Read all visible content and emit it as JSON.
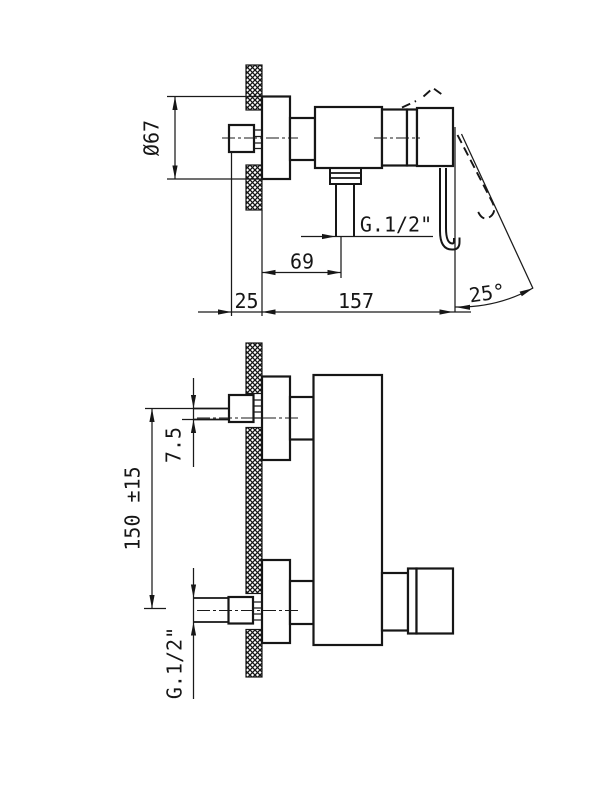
{
  "drawing": {
    "title": "wall-mounted single-lever shower mixer - dimensioned technical drawing, two orthographic views",
    "colors": {
      "background": "#ffffff",
      "ink": "#161616"
    },
    "top_view": {
      "label_diameter": "Ø67",
      "label_thread": "G.1/2\"",
      "label_outlet_offset": "69",
      "label_wall_depth": "25",
      "label_length": "157",
      "label_handle_angle": "25°"
    },
    "bottom_view": {
      "label_eccentric_offset": "7.5",
      "label_centre_distance": "150 ±15",
      "label_thread": "G.1/2\""
    }
  }
}
